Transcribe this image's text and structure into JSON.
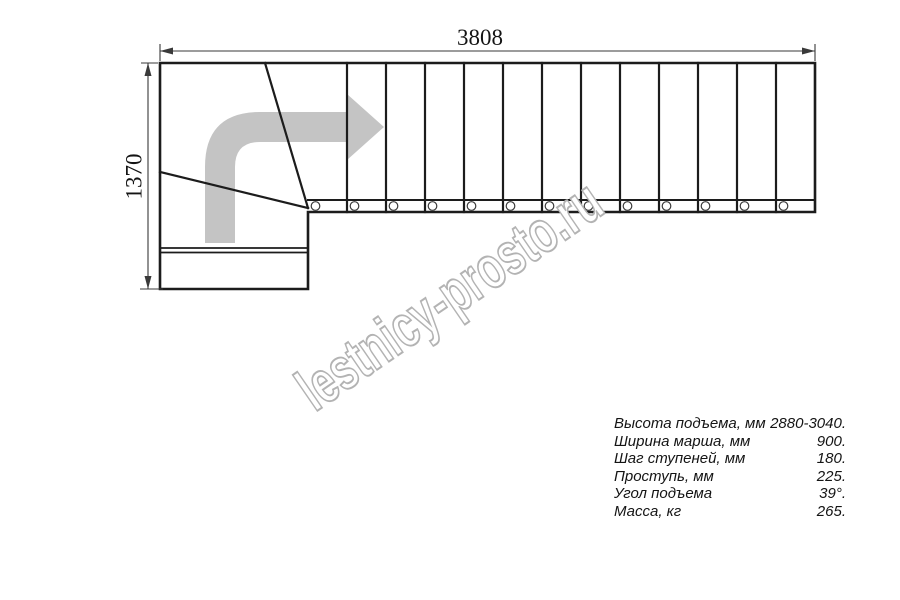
{
  "page": {
    "background": "#ffffff",
    "description": "Plan view drawing of an L-shaped staircase with winder steps"
  },
  "dimensions": {
    "total_length_label": "3808",
    "total_width_label": "1370"
  },
  "stairs": {
    "straight_tread_count": 13,
    "baluster_count": 13,
    "winder_tread_count": 2,
    "direction_arrow": "up-then-turn-right-arrow"
  },
  "watermark": {
    "text": "lestnicy-prosto.ru",
    "stroke_color": "#b3b3b3",
    "fill_color": "#ffffff"
  },
  "specs": {
    "rows": [
      {
        "label": "Высота подъема, мм",
        "value": "2880-3040."
      },
      {
        "label": "Ширина марша, мм",
        "value": "900."
      },
      {
        "label": "Шаг ступеней, мм",
        "value": "180."
      },
      {
        "label": "Проступь, мм",
        "value": "225."
      },
      {
        "label": "Угол подъема",
        "value": "39°."
      },
      {
        "label": "Масса, кг",
        "value": "265."
      }
    ]
  },
  "colors": {
    "line": "#1c1c1c",
    "circle_line": "#3c3c3c",
    "dim": "#3a3a3a",
    "arrow": "#c4c4c4"
  }
}
